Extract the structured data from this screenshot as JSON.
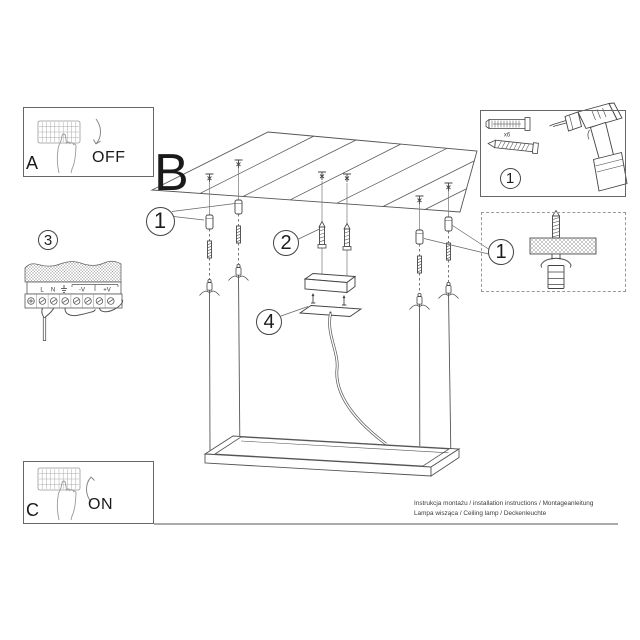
{
  "sheet": {
    "sections": {
      "a": {
        "label": "A",
        "switch_state": "OFF"
      },
      "b": {
        "label": "B"
      },
      "c": {
        "label": "C",
        "switch_state": "ON"
      }
    },
    "steps": {
      "suspension": "1",
      "canopy_screws": "2",
      "wiring": "3",
      "canopy_plate": "4",
      "mount_detail": "1",
      "tools": "1"
    },
    "tools": {
      "dowel_quantity": "x6"
    },
    "wiring": {
      "terminal_labels": [
        "L",
        "N",
        "⏚",
        "-V",
        "+V"
      ]
    },
    "footer": {
      "line1": "Instrukcja montażu / installation instructions / Montageanleitung",
      "line2": "Lampa wisząca / Ceiling lamp / Deckenleuchte"
    },
    "colors": {
      "line": "#444444",
      "light_line": "#9a9a9a",
      "background": "#ffffff"
    }
  }
}
